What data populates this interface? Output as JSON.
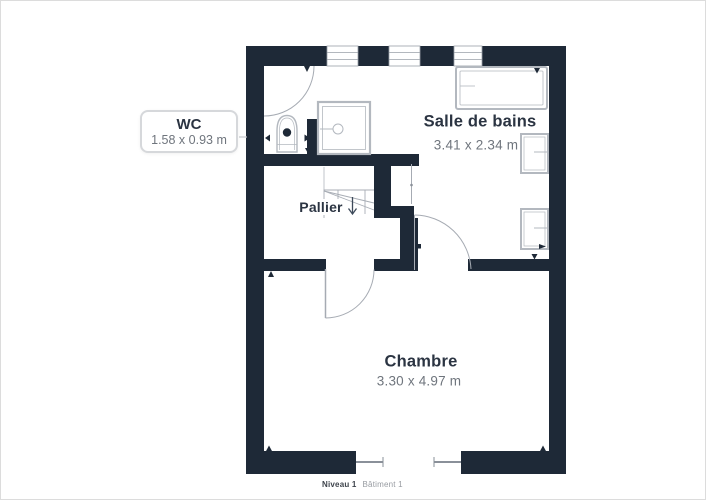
{
  "page": {
    "background": "#ffffff",
    "border_color": "#dcdcdc"
  },
  "floorplan": {
    "rooms": {
      "wc": {
        "name": "WC",
        "dimensions": "1.58 x 0.93 m"
      },
      "salle_de_bains": {
        "name": "Salle de bains",
        "dimensions": "3.41 x 2.34 m"
      },
      "pallier": {
        "name": "Pallier"
      },
      "chambre": {
        "name": "Chambre",
        "dimensions": "3.30 x 4.97 m"
      }
    },
    "footer": {
      "level": "Niveau 1",
      "building": "Bâtiment 1"
    },
    "colors": {
      "wall": "#1e2937",
      "fixture_outline": "#b3b8bf",
      "door_arc": "#a6abb3",
      "stair_line": "#a8adb5",
      "window_line": "#9aa0a8",
      "opening_line": "#8a9099",
      "connector_line": "#c6c9cd",
      "room_name_text": "#2b3442",
      "dimension_text": "#6f757d",
      "callout_border": "#d6d8db",
      "footer_level_text": "#3d434b",
      "footer_building_text": "#979ba1"
    }
  }
}
